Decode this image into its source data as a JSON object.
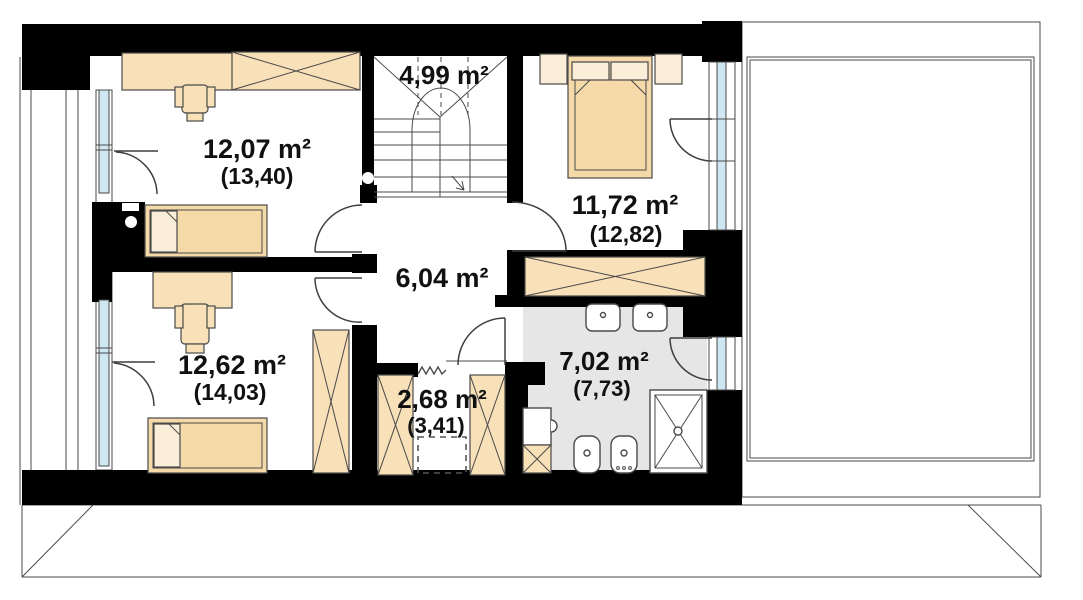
{
  "rooms": [
    {
      "area_label": "4,99 m²",
      "gross_label": ""
    },
    {
      "area_label": "12,07 m²",
      "gross_label": "(13,40)"
    },
    {
      "area_label": "11,72 m²",
      "gross_label": "(12,82)"
    },
    {
      "area_label": "6,04 m²",
      "gross_label": ""
    },
    {
      "area_label": "12,62 m²",
      "gross_label": "(14,03)"
    },
    {
      "area_label": "2,68 m²",
      "gross_label": "(3,41)"
    },
    {
      "area_label": "7,02 m²",
      "gross_label": "(7,73)"
    }
  ],
  "colors": {
    "wall": "#000000",
    "line": "#4a4a4a",
    "furniture": "#f8e0b8",
    "furniture_light": "#fbeed8",
    "bed": "#f5d9a8",
    "glass": "#cfe7f2",
    "bathroom_floor": "#e6e6e6",
    "text": "#111111"
  }
}
